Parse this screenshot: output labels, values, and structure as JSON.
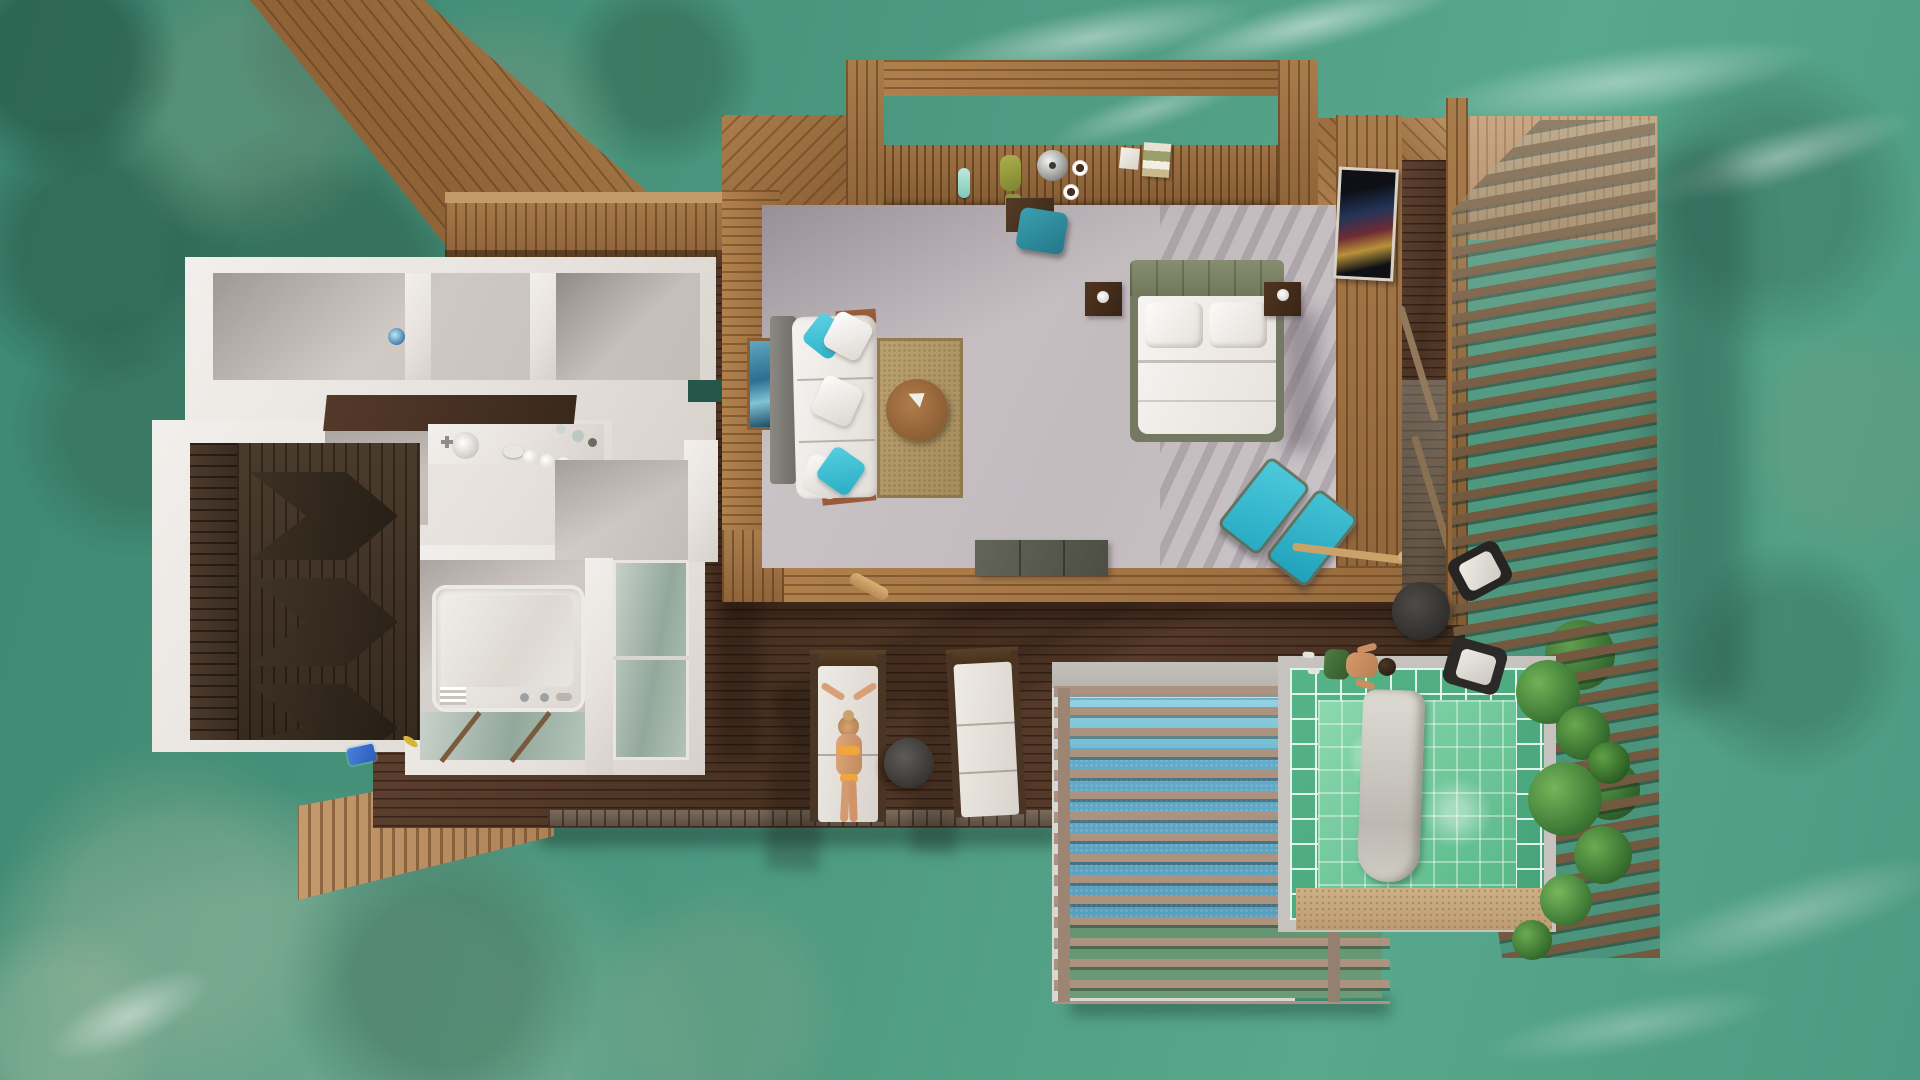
{
  "scene": {
    "title": "Aerial top-down 3D render of an overwater villa in a turquoise lagoon",
    "setting": "shallow lagoon with coral reef patches, white wave foam and sandy shallows",
    "villa": {
      "areas": [
        "diagonal entry jetty",
        "wooden walkway",
        "bathroom suite with vanity and shower",
        "walk-in closet with chevron wardrobes",
        "bathtub room over glass floor",
        "open living area",
        "bedroom",
        "over-water bar counter under pergola",
        "large sun deck",
        "blue plunge pool with slatted cover",
        "green tiled jacuzzi with towel",
        "louvered privacy screen",
        "slatted water ramp"
      ],
      "furniture": [
        "white sofa with turquoise pillows",
        "round wooden coffee table",
        "jute rug",
        "double bed with olive tufted headboard",
        "two dark nightstands with lamps",
        "wall mounted TV",
        "teal desk chair",
        "two cyan folding deck chairs",
        "two white sun loungers",
        "round gray side table",
        "black patio chairs with white cushions",
        "freestanding white bathtub",
        "vanity with round sink",
        "gray storage bench"
      ],
      "people": [
        "woman in orange bikini sunbathing on lounger",
        "man in green shorts walking near pool"
      ],
      "details": [
        "silver kettle and coffee cups on bar",
        "green vase",
        "books and boxes on bar",
        "kayak paddle on floor",
        "yellow fish in lagoon",
        "blue towel at water steps",
        "potted greenery by jacuzzi"
      ]
    },
    "palette": {
      "ocean": "#4a977e",
      "ocean_deep": "#37816c",
      "ocean_light": "#6fb299",
      "deck_wood": "#4f3626",
      "frame_wood": "#a87a48",
      "light_wood": "#c49a6c",
      "white_wall": "#ece8e4",
      "interior_floor": "#c9c2c5",
      "closet_wood": "#44372a",
      "bed_linen": "#f3f1ee",
      "headboard": "#7d8368",
      "accent_cyan": "#3cc2d8",
      "pool_blue": "#62abca",
      "jacuzzi_tile": "#53b084",
      "jacuzzi_water": "#82d3a8",
      "slat_wood": "#a8907e",
      "louver_wood": "#6e5641",
      "rug": "#b49a6e",
      "plant_green": "#3f7a36",
      "sand": "#c9ab7f",
      "skin": "#cf9a6e",
      "bikini": "#f0a63c"
    }
  }
}
